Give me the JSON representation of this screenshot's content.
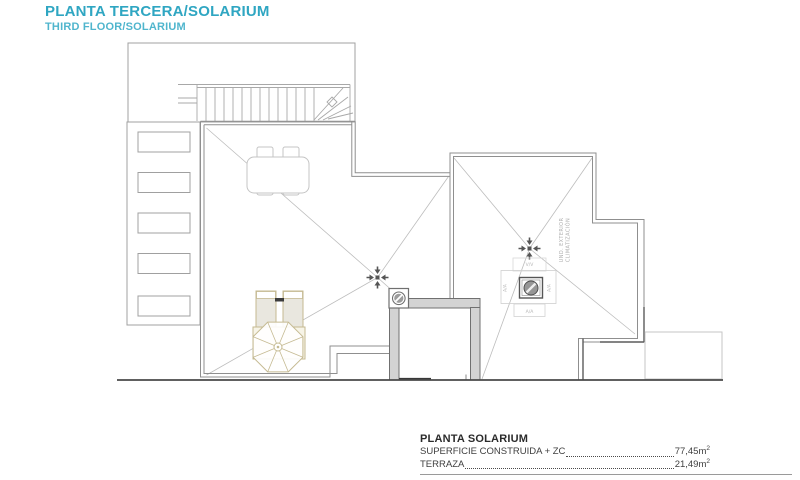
{
  "header": {
    "title": "PLANTA TERCERA/SOLARIUM",
    "subtitle": "THIRD FLOOR/SOLARIUM"
  },
  "legend": {
    "title": "PLANTA SOLARIUM",
    "rows": [
      {
        "label": "SUPERFICIE CONSTRUIDA + ZC",
        "value": "77,45m",
        "sup": "2"
      },
      {
        "label": "TERRAZA",
        "value": "21,49m",
        "sup": "2"
      }
    ]
  },
  "plan": {
    "labels": {
      "vv": "V/V",
      "aa_left": "A/A",
      "aa_right": "A/A",
      "aa_bottom": "A/A",
      "unit_line1": "UND. EXTERIOR",
      "unit_line2": "CLIMATIZACIÓN"
    }
  },
  "colors": {
    "title_teal": "#2FA6C2",
    "subtitle_teal": "#4FB5CD",
    "line_gray": "#A0A0A0",
    "parapet_gray": "#8F8F8F",
    "hip_gray": "#BDBDBD",
    "dark_line": "#4A4A4A",
    "wall_fill": "#D3D3D3",
    "furniture_gray": "#C4C4C4",
    "beige_stroke": "#C5BA92",
    "beige_fill": "#F7F4E7",
    "label_gray": "#AFAFAF",
    "legend_text": "#3F3F3F"
  }
}
